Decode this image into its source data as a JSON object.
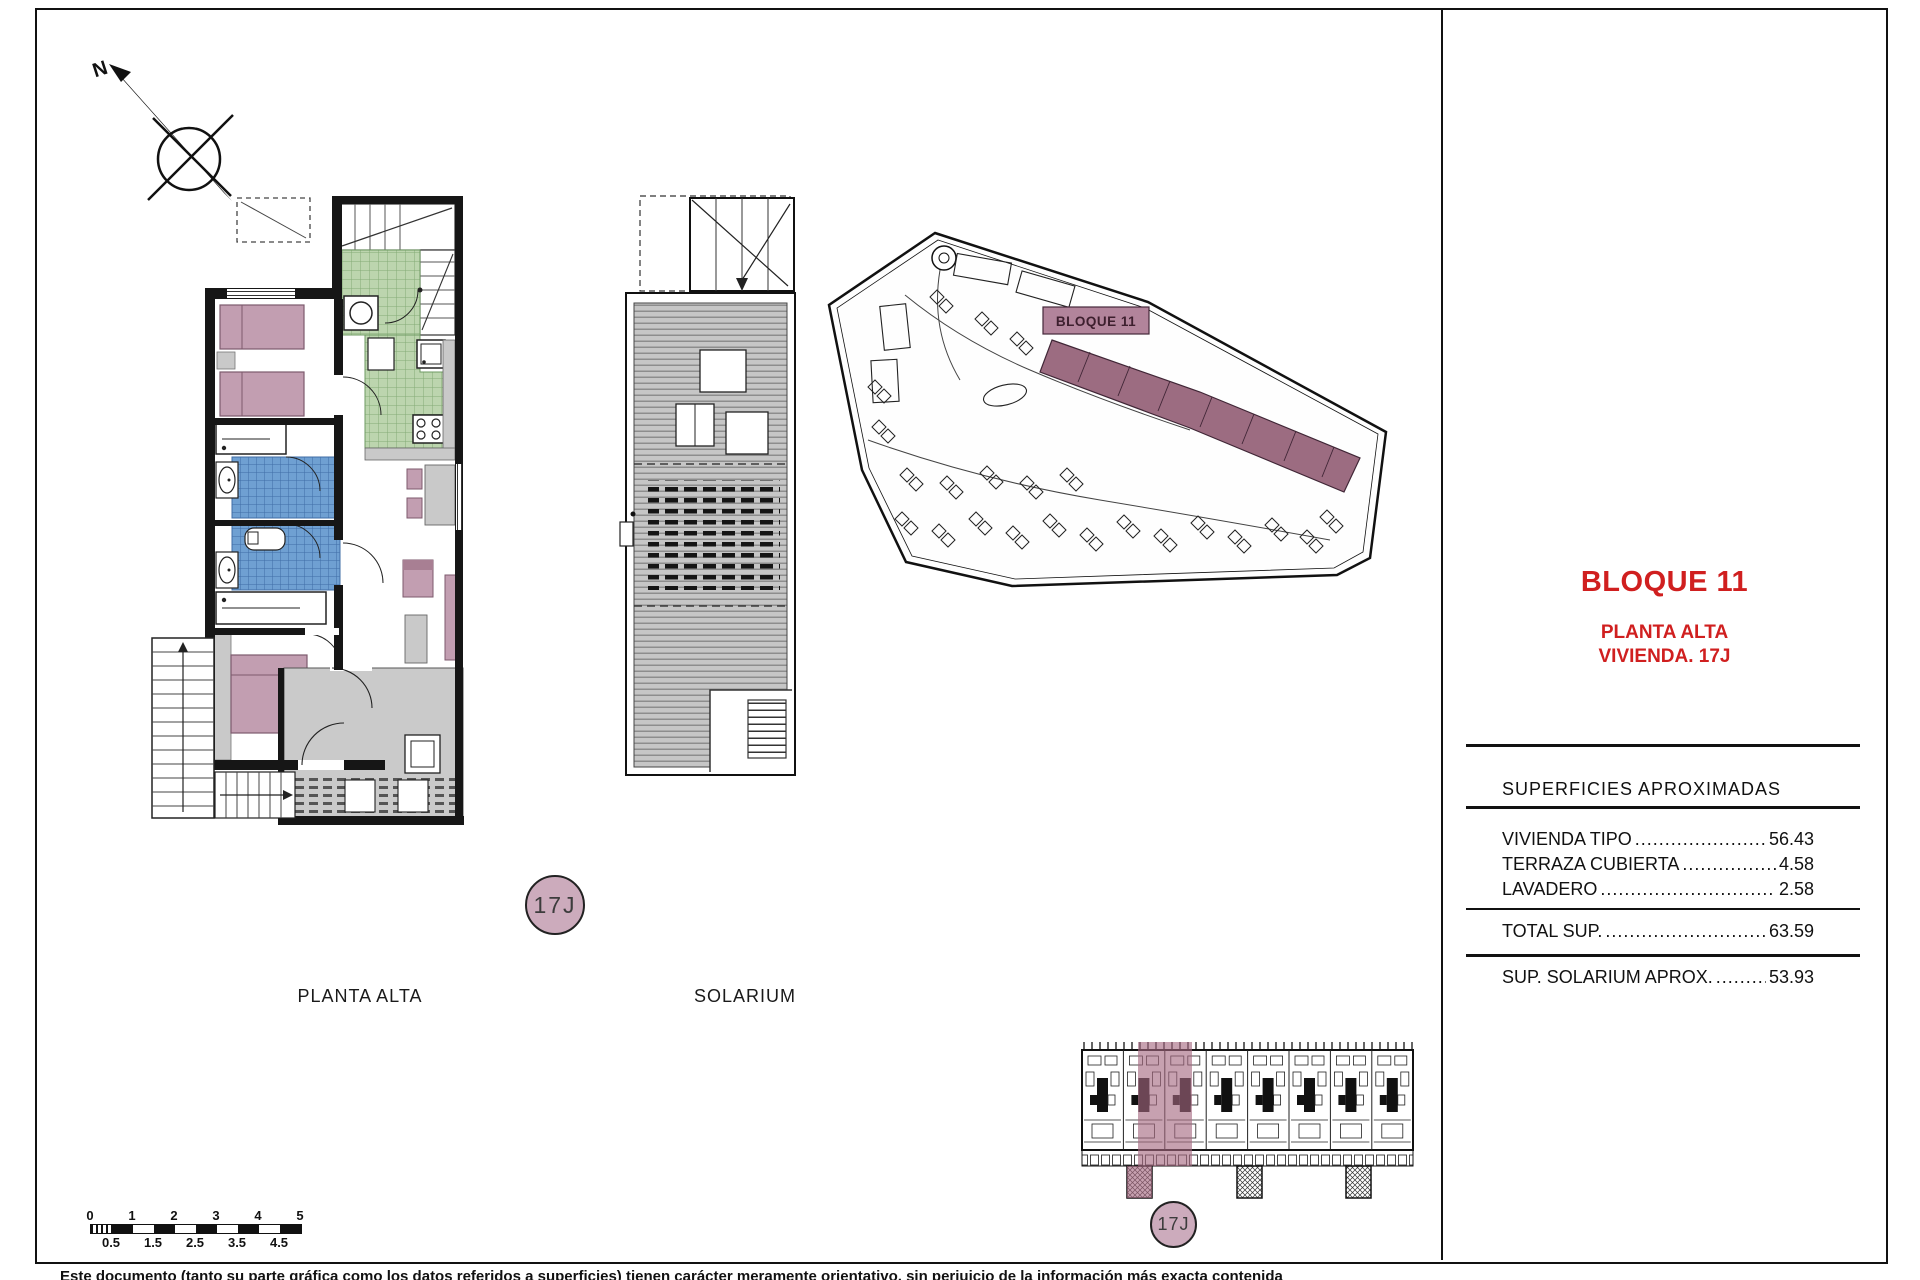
{
  "page": {
    "disclaimer": "Este documento (tanto su parte gráfica como los datos referidos a superficies) tienen carácter meramente orientativo, sin perjuicio de la información más exacta contenida"
  },
  "compass": {
    "north_label": "N"
  },
  "plans": {
    "planta_alta": {
      "label": "PLANTA ALTA",
      "unit_badge": "17J"
    },
    "solarium": {
      "label": "SOLARIUM"
    },
    "site": {
      "block_label": "BLOQUE 11"
    },
    "key_plan": {
      "unit_badge": "17J"
    }
  },
  "panel": {
    "title": "BLOQUE 11",
    "subtitle_line1": "PLANTA ALTA",
    "subtitle_line2": "VIVIENDA. 17J",
    "table": {
      "header": "SUPERFICIES APROXIMADAS",
      "rows": [
        {
          "label": "VIVIENDA TIPO",
          "dots": ".........................",
          "value": "56.43"
        },
        {
          "label": "TERRAZA CUBIERTA",
          "dots": "..................",
          "value": "4.58"
        },
        {
          "label": "LAVADERO",
          "dots": "..................................",
          "value": "2.58"
        }
      ],
      "total_row": {
        "label": "TOTAL SUP.",
        "dots": "................................",
        "value": "63.59"
      },
      "solarium_row": {
        "label": "SUP. SOLARIUM APROX.",
        "dots": ".........",
        "value": "53.93"
      }
    }
  },
  "scale_bar": {
    "top_labels": [
      "0",
      "1",
      "2",
      "3",
      "4",
      "5"
    ],
    "bottom_labels": [
      "0.5",
      "1.5",
      "2.5",
      "3.5",
      "4.5"
    ]
  },
  "colors": {
    "accent_red": "#d01f1f",
    "room_mauve": "#c29eb1",
    "kitchen_green": "#bcd5ae",
    "bath_blue": "#6fa0d2",
    "terrace_gray": "#cacaca",
    "site_block_mauve": "#9c6c81"
  }
}
